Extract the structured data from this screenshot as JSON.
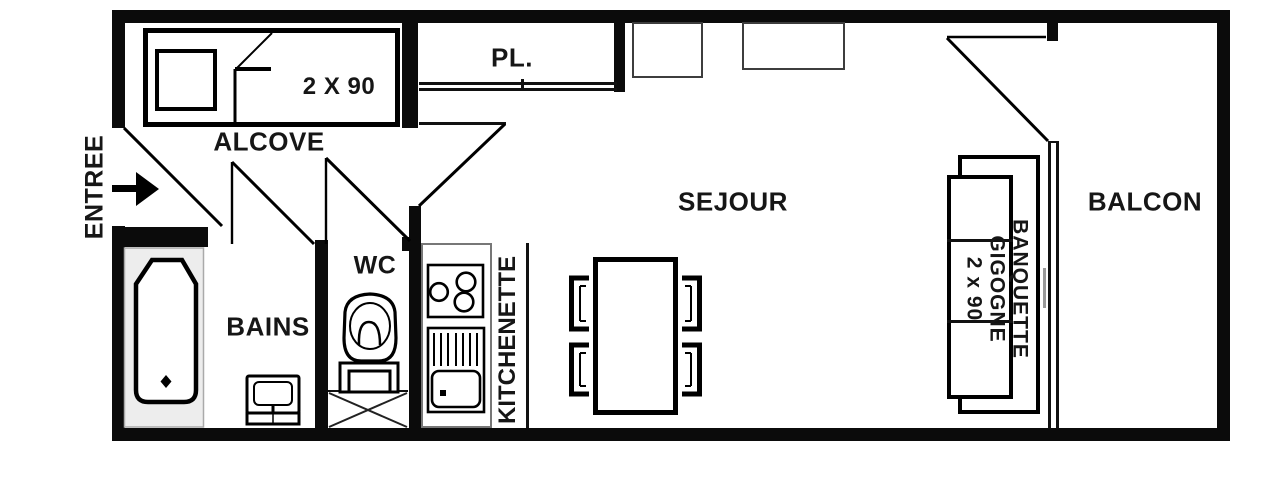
{
  "entrance": {
    "label": "ENTREE"
  },
  "rooms": {
    "alcove": {
      "label": "ALCOVE",
      "bed_dimensions": "2 X 90"
    },
    "closet": {
      "label": "PL."
    },
    "living_room": {
      "label": "SEJOUR"
    },
    "balcony": {
      "label": "BALCON"
    },
    "toilet": {
      "label": "WC"
    },
    "bathroom": {
      "label": "BAINS"
    },
    "kitchenette": {
      "label": "KITCHENETTE"
    }
  },
  "furniture": {
    "sofa_bed": {
      "line1": "BANQUETTE",
      "line2": "GIGOGNE",
      "line3": "2 x 90"
    }
  },
  "colors": {
    "walls": "#0b0b0b",
    "background": "#ffffff",
    "tub_fill": "#ededed",
    "detail_gray": "#999999"
  }
}
